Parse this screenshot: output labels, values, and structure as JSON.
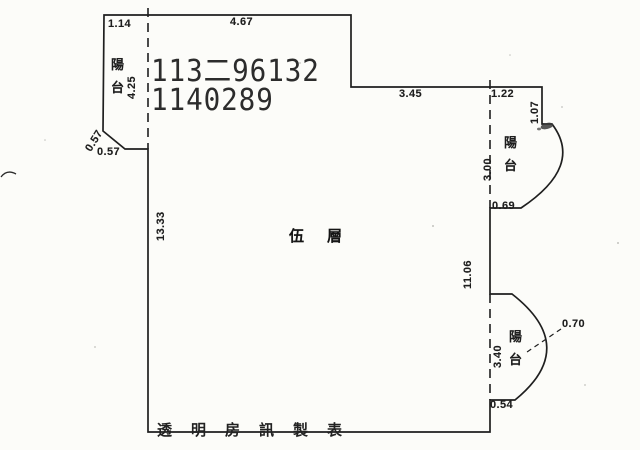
{
  "document": {
    "type_note": "scanned floor plan",
    "floor_label": "伍　層",
    "footer_label": "透明房訊製表",
    "stamp": {
      "line1": "113二96132",
      "line2": "1140289"
    }
  },
  "balconies": {
    "top_left": {
      "label": "陽\n台"
    },
    "top_right": {
      "label": "陽\n台"
    },
    "bottom_right": {
      "label": "陽\n台"
    }
  },
  "dimensions": {
    "top_left_width": "1.14",
    "top_width": "4.67",
    "left_balcony_height": "4.25",
    "left_diagonal": "0.57",
    "left_step": "0.57",
    "left_height": "13.33",
    "mid_top_width": "3.45",
    "right_top_width": "1.22",
    "right_top_height": "1.07",
    "right_balcony_height": "3.00",
    "right_balcony_bottom": "0.69",
    "right_height": "11.06",
    "lower_balcony_height": "3.40",
    "lower_balcony_depth": "0.70",
    "lower_balcony_bottom": "0.54"
  },
  "colors": {
    "ink": "#1f1f1f",
    "paper": "#fcfcf9"
  }
}
